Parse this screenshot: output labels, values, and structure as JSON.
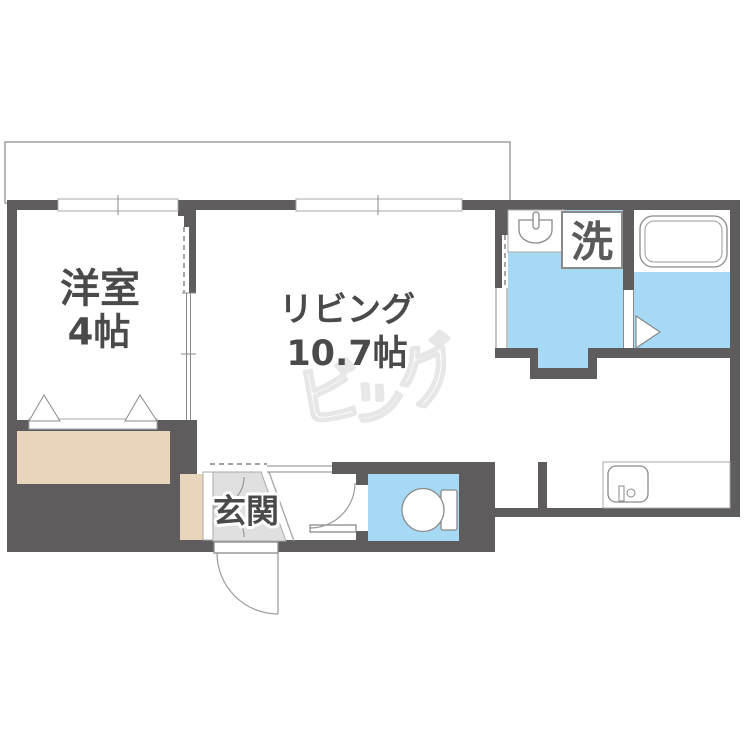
{
  "labels": {
    "western_room": "洋室",
    "western_room_size": "4帖",
    "living": "リビング",
    "living_size": "10.7帖",
    "laundry": "洗",
    "entrance": "玄関"
  },
  "watermark": {
    "char1": "ビ",
    "char2": "ッ",
    "char3": "グ"
  },
  "colors": {
    "wall": "#5e5c5c",
    "water": "#a5d9f4",
    "storage": "#e8d5bb",
    "entrance_floor": "#e0e0e0",
    "line": "#8a8a8a",
    "label_text": "#4a4a4a",
    "laundry_text": "#5a5a5a",
    "watermark_outline": "#e7e7e7"
  }
}
